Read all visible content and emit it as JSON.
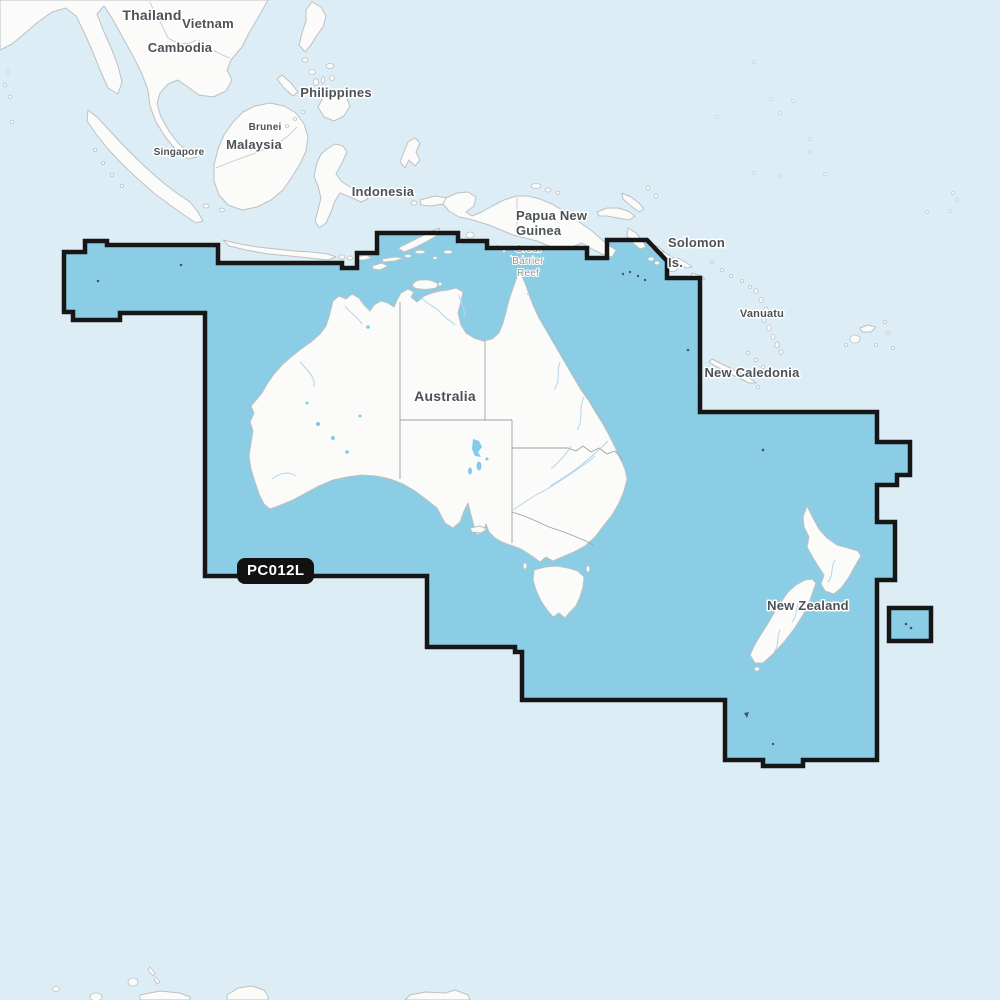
{
  "map": {
    "kind": "marine-chart-coverage-map",
    "badge": {
      "code": "PC012L"
    },
    "colors": {
      "ocean": "#ddedf5",
      "coverage_fill": "#8acde4",
      "coverage_border": "#161616",
      "land": "#fbfbfa",
      "land_border": "#bcc1c2",
      "admin_border": "#9ba1a3",
      "river": "#b2d6ea",
      "lake": "#7fcbe9",
      "label": "#4b5256",
      "reef_label": "#8e979c",
      "badge_bg": "#121212",
      "badge_text": "#ffffff"
    },
    "labels": [
      {
        "id": "thailand",
        "text": "Thailand",
        "x": 152,
        "y": 20,
        "size": 14
      },
      {
        "id": "vietnam",
        "text": "Vietnam",
        "x": 208,
        "y": 28,
        "size": 13
      },
      {
        "id": "cambodia",
        "text": "Cambodia",
        "x": 180,
        "y": 52,
        "size": 13
      },
      {
        "id": "philippines",
        "text": "Philippines",
        "x": 336,
        "y": 97,
        "size": 13
      },
      {
        "id": "brunei",
        "text": "Brunei",
        "x": 265,
        "y": 130,
        "size": 10,
        "weight": 600
      },
      {
        "id": "malaysia",
        "text": "Malaysia",
        "x": 254,
        "y": 149,
        "size": 13
      },
      {
        "id": "singapore",
        "text": "Singapore",
        "x": 179,
        "y": 155,
        "size": 10,
        "weight": 600
      },
      {
        "id": "indonesia",
        "text": "Indonesia",
        "x": 383,
        "y": 196,
        "size": 13
      },
      {
        "id": "papua-new-guinea",
        "text": "Papua New\nGuinea",
        "x": 516,
        "y": 220,
        "size": 13,
        "align": "left",
        "lh": 15
      },
      {
        "id": "solomon-is",
        "text": "Solomon\nIs.",
        "x": 668,
        "y": 247,
        "size": 13,
        "align": "left",
        "lh": 20
      },
      {
        "id": "vanuatu",
        "text": "Vanuatu",
        "x": 762,
        "y": 317,
        "size": 11
      },
      {
        "id": "new-caledonia",
        "text": "New Caledonia",
        "x": 752,
        "y": 377,
        "size": 13
      },
      {
        "id": "australia",
        "text": "Australia",
        "x": 445,
        "y": 401,
        "size": 14
      },
      {
        "id": "new-zealand",
        "text": "New Zealand",
        "x": 808,
        "y": 610,
        "size": 13
      },
      {
        "id": "great-barrier-reef",
        "text": "Great\nBarrier\nReef",
        "x": 528,
        "y": 252,
        "size": 10,
        "muted": true,
        "layer": "under",
        "lh": 12
      }
    ]
  }
}
